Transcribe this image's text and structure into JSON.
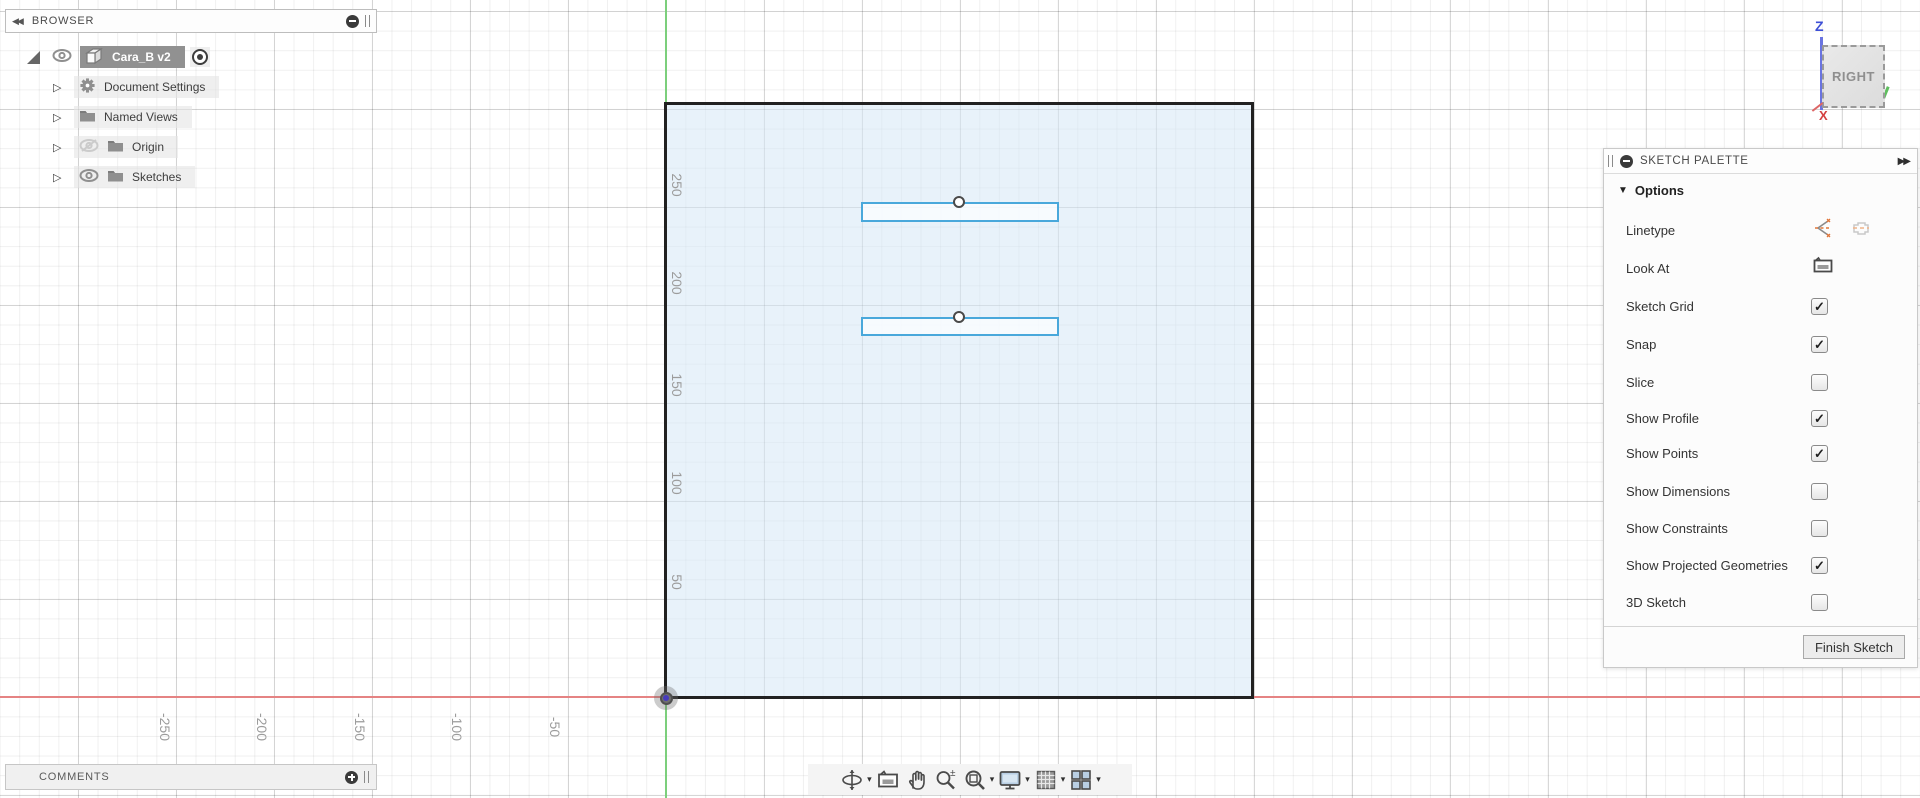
{
  "browser": {
    "collapse_icon": "◀◀",
    "title": "BROWSER",
    "root": {
      "label": "Cara_B v2"
    },
    "items": [
      {
        "label": "Document Settings",
        "icon": "gear"
      },
      {
        "label": "Named Views",
        "icon": "folder"
      },
      {
        "label": "Origin",
        "icon": "folder",
        "visibility": "hidden"
      },
      {
        "label": "Sketches",
        "icon": "folder",
        "visibility": "visible"
      }
    ]
  },
  "comments": {
    "title": "COMMENTS"
  },
  "viewcube": {
    "face": "RIGHT",
    "z_label": "Z",
    "x_label": "X"
  },
  "palette": {
    "title": "SKETCH PALETTE",
    "expand_icon": "▶▶",
    "section": "Options",
    "rows": [
      {
        "label": "Linetype",
        "control": "linetype-icons"
      },
      {
        "label": "Look At",
        "control": "look-at-icon"
      },
      {
        "label": "Sketch Grid",
        "control": "checkbox",
        "checked": true
      },
      {
        "label": "Snap",
        "control": "checkbox",
        "checked": true
      },
      {
        "label": "Slice",
        "control": "checkbox",
        "checked": false
      },
      {
        "label": "Show Profile",
        "control": "checkbox",
        "checked": true
      },
      {
        "label": "Show Points",
        "control": "checkbox",
        "checked": true
      },
      {
        "label": "Show Dimensions",
        "control": "checkbox",
        "checked": false
      },
      {
        "label": "Show Constraints",
        "control": "checkbox",
        "checked": false
      },
      {
        "label": "Show Projected Geometries",
        "control": "checkbox",
        "checked": true
      },
      {
        "label": "3D Sketch",
        "control": "checkbox",
        "checked": false
      }
    ],
    "finish_button": "Finish Sketch"
  },
  "canvas": {
    "y_axis_labels": [
      "250",
      "200",
      "150",
      "100",
      "50"
    ],
    "x_axis_labels": [
      "-250",
      "-200",
      "-150",
      "-100",
      "-50"
    ],
    "colors": {
      "x_axis": "#e58383",
      "y_axis": "#7ccf7c",
      "profile_fill": "#ddeaf6",
      "sketch_line": "#49a8db",
      "outline": "#212121",
      "grid_major": "#d9d9d9",
      "grid_minor": "#ececec"
    }
  },
  "nav_toolbar": {
    "items": [
      "orbit",
      "look-at",
      "pan",
      "zoom",
      "zoom-window",
      "display-settings",
      "grid-settings",
      "viewports"
    ]
  }
}
